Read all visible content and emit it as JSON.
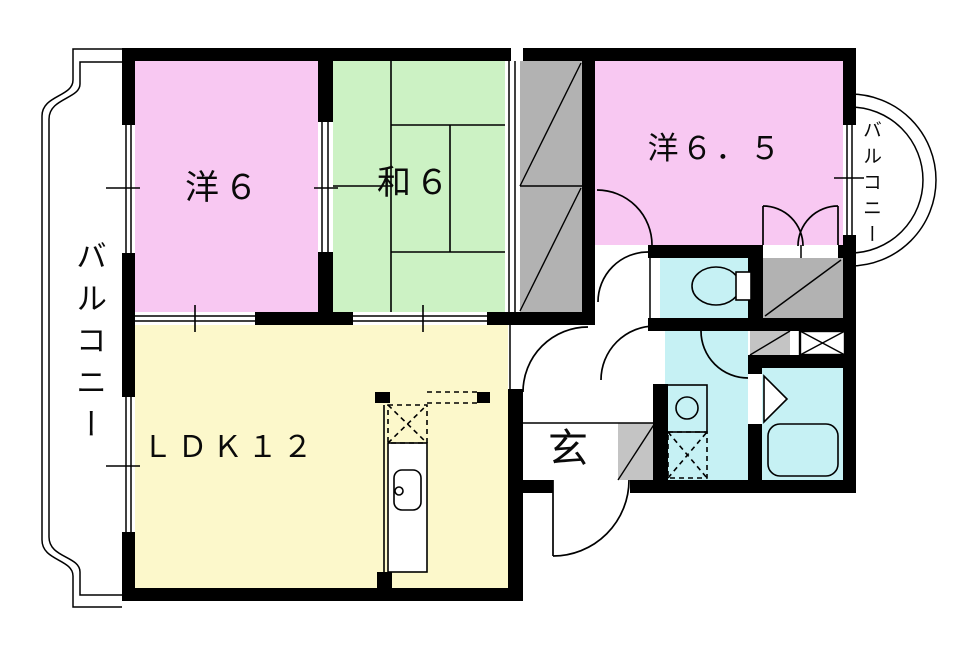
{
  "colors": {
    "wall": "#000000",
    "room_pink": "#f8c8f2",
    "room_green": "#ccf2c4",
    "room_yellow": "#fcf8cb",
    "room_cyan": "#c6f1f4",
    "closet_gray": "#b2b2b2",
    "step_gray": "#c4c4c4",
    "bg": "#ffffff"
  },
  "rooms": {
    "western_6": {
      "label": "洋６"
    },
    "japanese_6": {
      "label": "和６"
    },
    "western_6_5": {
      "label": "洋６．５"
    },
    "ldk_12": {
      "label": "ＬＤＫ１２"
    },
    "entrance": {
      "label": "玄"
    },
    "balcony_left": {
      "label": "バルコニー"
    },
    "balcony_right": {
      "label": "バルコニー"
    }
  },
  "fixtures": {
    "toilet": "toilet-bowl-with-tank",
    "bathtub": "rounded-rect-tub",
    "washbasin": "counter-with-round-basin",
    "kitchen_sink": "sink-with-faucet-dot",
    "washing_machine_space": "dashed-box-with-x",
    "stove_space": "dashed-box-with-x",
    "storage_box": "box-with-x",
    "closet_marks": "gray-panel-with-diagonal",
    "entry_step": "gray-square-with-diagonal",
    "doors": "quarter-arc-swings",
    "bath_door": "triangle-fold-mark"
  }
}
